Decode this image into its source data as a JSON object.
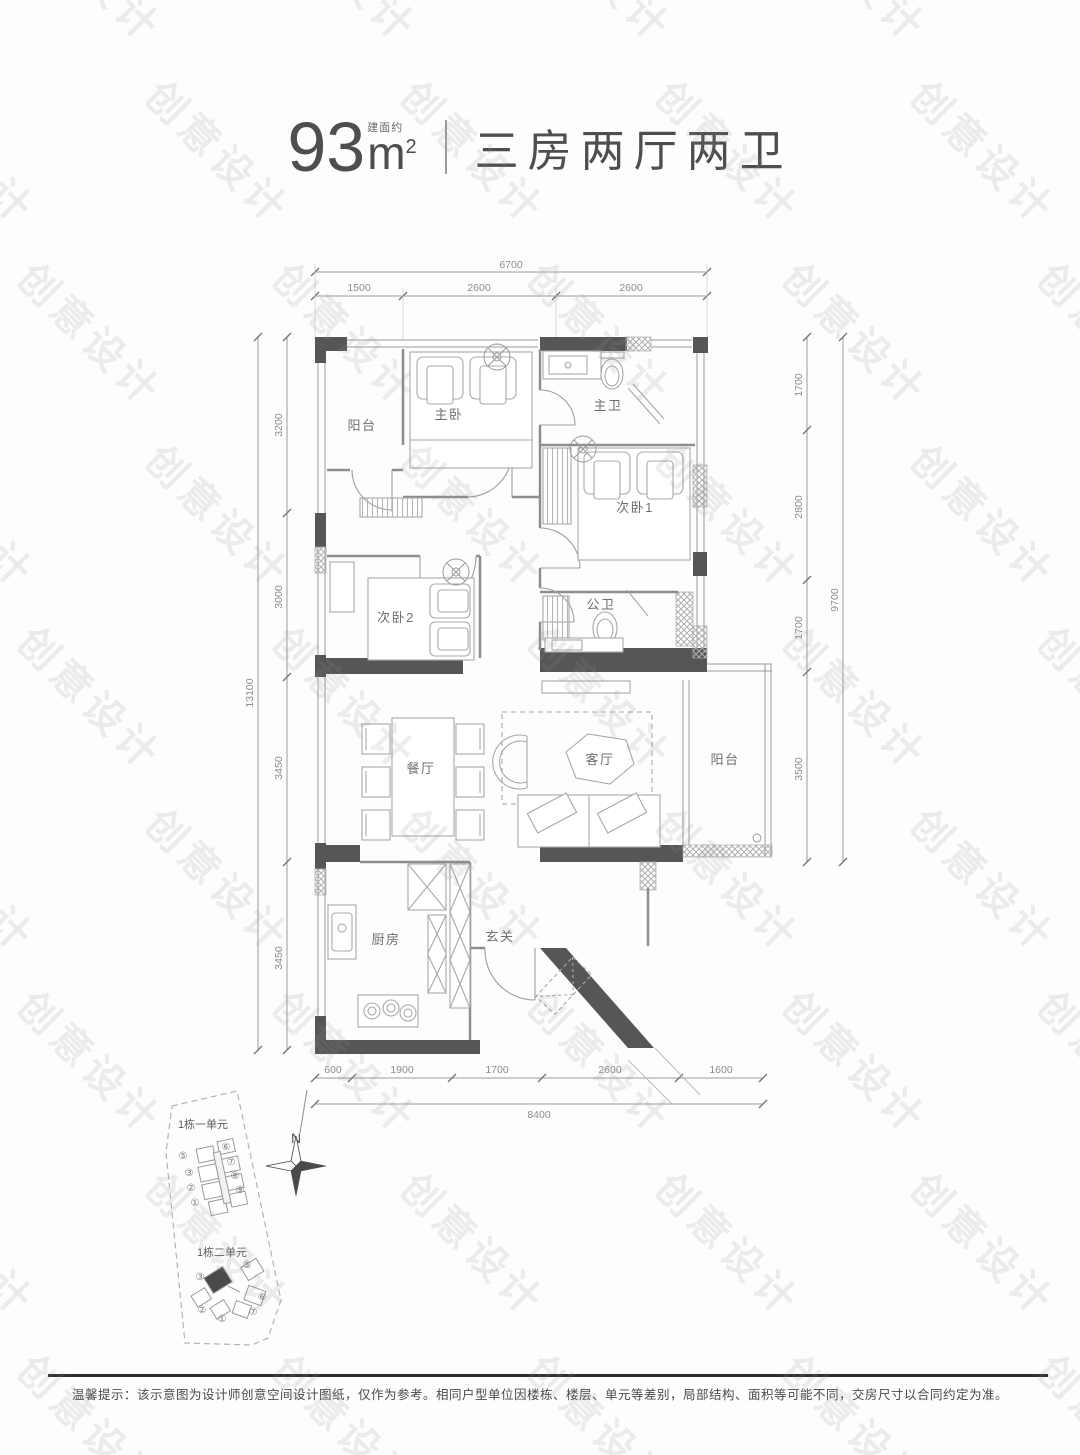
{
  "watermark": {
    "text": "创意设计"
  },
  "header": {
    "area_prefix": "建面约",
    "area_number": "93",
    "area_unit": "m",
    "area_sup": "2",
    "layout_title": "三房两厅两卫"
  },
  "rooms": {
    "balcony_top": "阳台",
    "master_bedroom": "主卧",
    "master_bath": "主卫",
    "bedroom1": "次卧1",
    "bedroom2": "次卧2",
    "public_bath": "公卫",
    "dining": "餐厅",
    "living": "客厅",
    "balcony_right": "阳台",
    "kitchen": "厨房",
    "foyer": "玄关"
  },
  "dims": {
    "top": {
      "total": "6700",
      "segments": [
        "1500",
        "2600",
        "2600"
      ]
    },
    "bottom": {
      "total": "8400",
      "segments": [
        "600",
        "1900",
        "1700",
        "2600",
        "1600"
      ]
    },
    "left": {
      "total": "13100",
      "segments": [
        "3200",
        "3000",
        "3450",
        "3450"
      ]
    },
    "right": {
      "total": "9700",
      "segments": [
        "1700",
        "2800",
        "1700",
        "3500"
      ]
    }
  },
  "siteplan": {
    "building1_label": "1栋一单元",
    "building2_label": "1栋二单元",
    "north_label": "N",
    "cluster1_left": [
      "⑤",
      "③",
      "②",
      "①"
    ],
    "cluster1_right": [
      "⑥",
      "⑦",
      "⑧",
      "⑨"
    ],
    "cluster2": [
      "③",
      "⑤",
      "⑥",
      "⑦",
      "①",
      "②"
    ]
  },
  "footer": {
    "disclaimer": "温馨提示：该示意图为设计师创意空间设计图纸，仅作为参考。相同户型单位因楼栋、楼层、单元等差别，局部结构、面积等可能不同，交房尺寸以合同约定为准。"
  },
  "colors": {
    "wall": "#565656",
    "thin_line": "#8e8e8e",
    "furniture": "#a8a8a8",
    "watermark": "#e8e4e0"
  }
}
